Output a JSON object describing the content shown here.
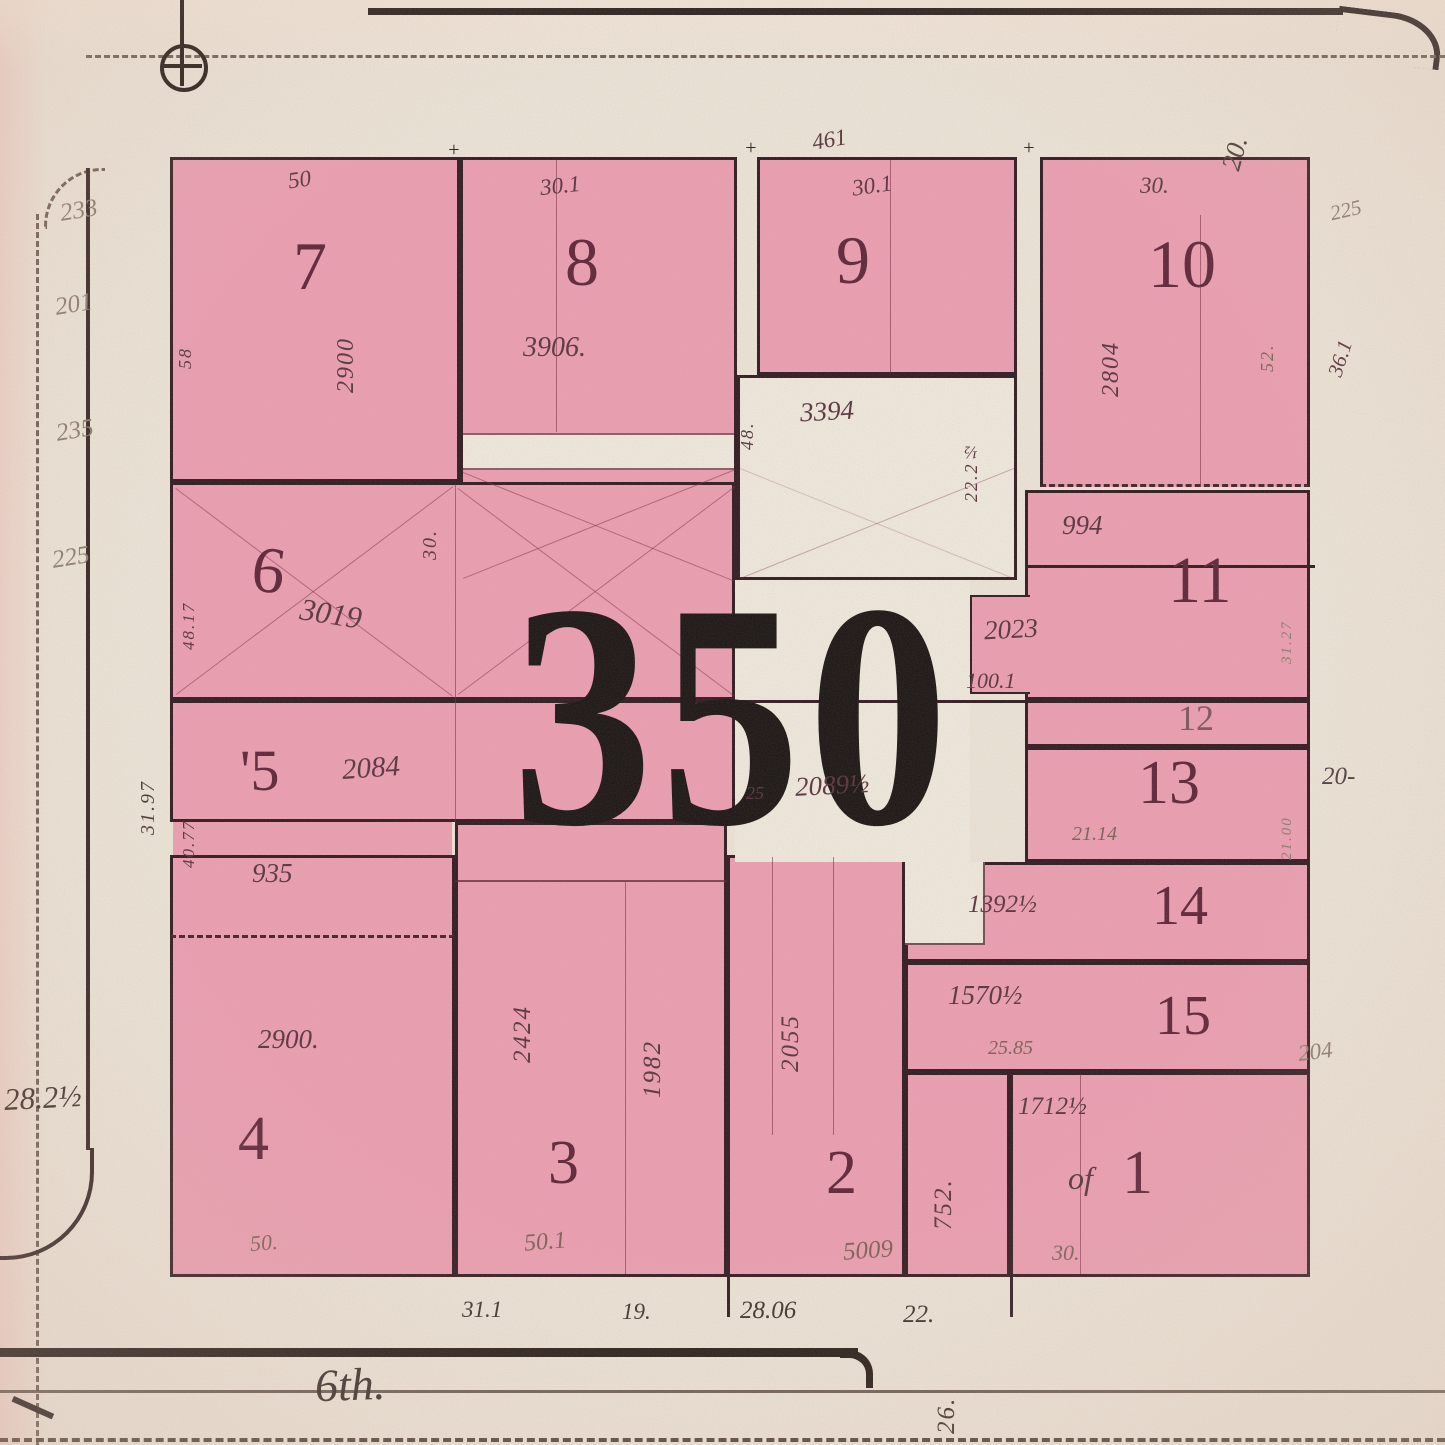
{
  "block": {
    "number": "350"
  },
  "street": {
    "name": "6th."
  },
  "lots": {
    "1": {
      "number": "1",
      "prefix": "of",
      "building": "1712½",
      "frontage": "30."
    },
    "2": {
      "number": "2",
      "building": "2055",
      "bottom": "5009"
    },
    "3": {
      "number": "3",
      "building_a": "2424",
      "building_b": "1982",
      "frontage": "50.1"
    },
    "4": {
      "number": "4",
      "building": "2900.",
      "upper": "935",
      "frontage": "50."
    },
    "5": {
      "number": "'5",
      "building": "2084",
      "depth": "40.77"
    },
    "6": {
      "number": "6",
      "building": "3019",
      "notch": "30.",
      "depth": "48.17"
    },
    "7": {
      "number": "7",
      "building": "2900",
      "frontage": "50",
      "side": "58"
    },
    "8": {
      "number": "8",
      "building": "3906.",
      "frontage": "30.1"
    },
    "9": {
      "number": "9",
      "frontage": "30.1"
    },
    "10": {
      "number": "10",
      "building": "2804",
      "frontage": "30.",
      "side": "52.",
      "depth": "36.1"
    },
    "11": {
      "number": "11",
      "upper": "994",
      "building": "2023",
      "dim": "100.1"
    },
    "12": {
      "number": "12"
    },
    "13": {
      "number": "13",
      "below": "21.14"
    },
    "14": {
      "number": "14",
      "building": "1392½"
    },
    "15": {
      "number": "15",
      "building": "1570½",
      "below": "25.85"
    },
    "aux752": {
      "building": "752."
    }
  },
  "open_areas": {
    "upper": {
      "label": "3394",
      "left": "48.",
      "right": "22.2½"
    },
    "court": {
      "label": "2089½",
      "left": "25"
    }
  },
  "margins": {
    "top": {
      "dim": "461",
      "corner": "20."
    },
    "right": {
      "a": "225",
      "b": "36.1",
      "c": "20-",
      "d": "204",
      "chain_a": "31.27",
      "chain_b": "21.00"
    },
    "left": {
      "a": "233",
      "b": "201",
      "c": "235",
      "d": "225",
      "e": "31.97",
      "f": "28.2½"
    },
    "bottom": {
      "a": "31.1",
      "b": "19.",
      "c": "28.06",
      "d": "22.",
      "e": "26."
    }
  },
  "marks": {
    "a": "+",
    "b": "+",
    "c": "+"
  }
}
